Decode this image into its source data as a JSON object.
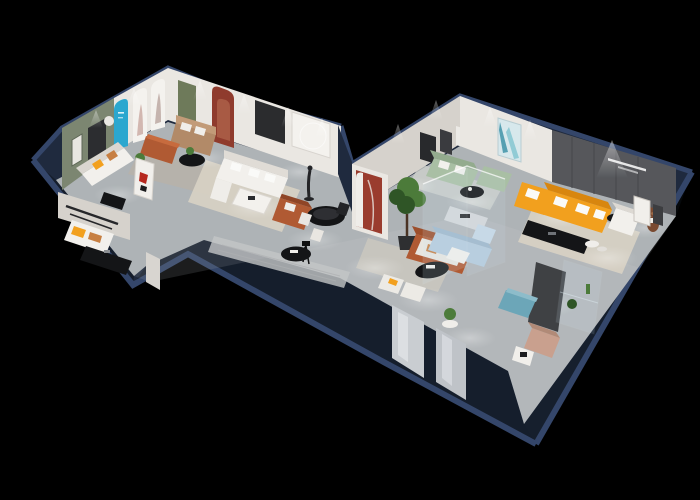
{
  "scene": {
    "type": "3d-isometric-dollhouse-floorplan-render",
    "subject": "furniture showroom cutaway with navy walls on black backdrop",
    "background": "#000000"
  },
  "palette": {
    "background": "#000000",
    "wall_navy": "#1f2a3e",
    "wall_navy_top": "#34466a",
    "wall_navy_deep": "#0c1119",
    "floor": "#b3b7ba",
    "floor_dim": "#9aa0a5",
    "wall_white": "#eae7e2",
    "wall_shade": "#d6d2cc",
    "sage_wall": "#7c8671",
    "olive_door": "#6e7a5a",
    "blue_arch": "#2ba7cf",
    "red_niche": "#8f3b2d",
    "red_column": "#9a3c2e",
    "dark_accent_wall": "#56575b",
    "orange_sofa": "#f2a01e",
    "orange_deep": "#d8860f",
    "rust": "#b05a33",
    "tan_sofa": "#b28a68",
    "sage_sofa": "#a9bfa4",
    "blue_sofa": "#b5cbdd",
    "teal_bench": "#6ca6b8",
    "blush_chair": "#c9a08e",
    "bear_brown": "#7a4a31",
    "black_furniture": "#141517",
    "plant_green": "#4c7b3a",
    "plant_dark": "#2f5526",
    "rug_cream": "#d8d2c4",
    "rug_gray": "#b6b2ab",
    "white": "#f2f0ec",
    "glass_tint": "#cfe6f2"
  },
  "zones": [
    {
      "name": "gallery-room",
      "items": [
        "sage-accent-wall",
        "wall-art-frames",
        "blue-arch-sign",
        "white-arch-panels",
        "olive-door",
        "red-arch-niche",
        "tan-loveseat",
        "rust-ottoman",
        "black-coffee-table",
        "area-rug"
      ]
    },
    {
      "name": "left-lounge",
      "items": [
        "white-sofa-orange-pillows",
        "black-desk",
        "side-chair",
        "red-poster-panel",
        "rust-armchair"
      ]
    },
    {
      "name": "front-den",
      "items": [
        "wall-shelf",
        "daybed",
        "black-media-console"
      ]
    },
    {
      "name": "center-corridor",
      "items": [
        "white-l-sectional",
        "white-dining-table",
        "black-round-dining-table",
        "dining-chairs",
        "mannequin-sculpture",
        "tripod-lamp",
        "striped-runner-rug",
        "black-oval-table",
        "armchair-pair",
        "art-wall-circle-decor"
      ]
    },
    {
      "name": "junction",
      "items": [
        "red-arch-column",
        "potted-tree",
        "terracotta-sofa",
        "black-organic-coffee-table"
      ]
    },
    {
      "name": "sage-lounge",
      "items": [
        "sage-sofa",
        "sage-chaise",
        "black-round-table",
        "teal-abstract-painting",
        "dark-art-frames"
      ]
    },
    {
      "name": "glass-room",
      "items": [
        "glass-partitions",
        "light-blue-sofa-set",
        "white-coffee-table",
        "kitchen-island"
      ]
    },
    {
      "name": "main-showroom",
      "items": [
        "dark-slogan-wall",
        "orange-l-sectional",
        "black-media-console",
        "white-armchair",
        "teddy-bear-plush",
        "leaning-art-frames",
        "nesting-tables",
        "cream-rug"
      ]
    },
    {
      "name": "front-right",
      "items": [
        "dark-partition",
        "glass-display-case",
        "cactus-plants",
        "teal-bench",
        "blush-armchair",
        "magazine-holder",
        "mirror-door-panels",
        "pedestal-plant"
      ]
    }
  ],
  "lighting": {
    "style": "recessed-spotlights",
    "floor_pools": 14,
    "wall_cones": 11
  }
}
